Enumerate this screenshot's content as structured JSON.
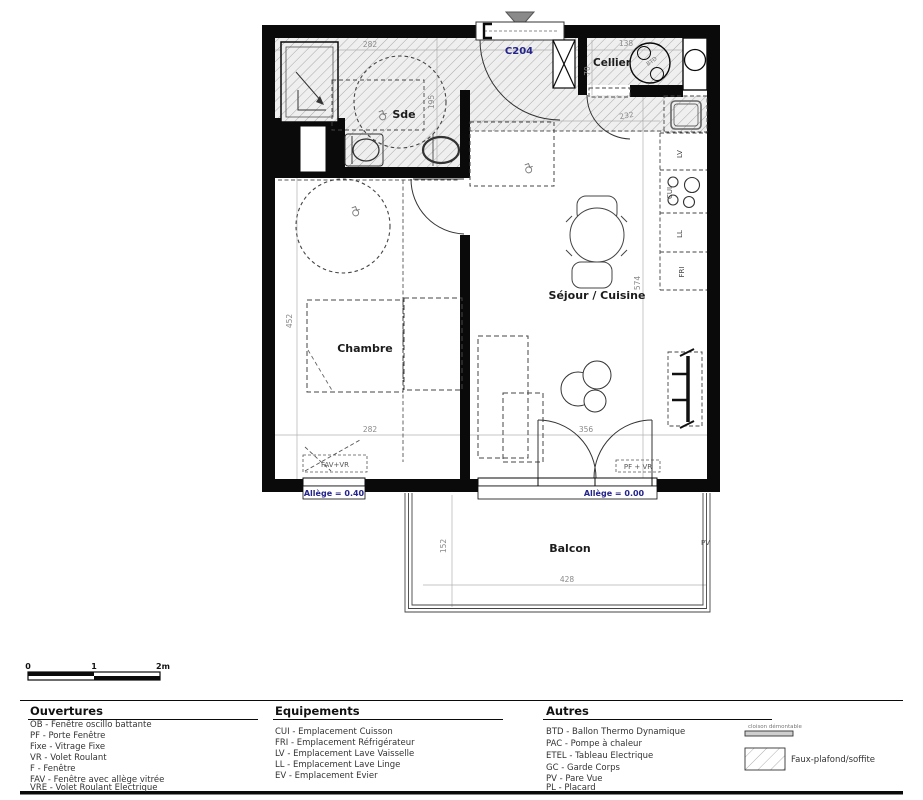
{
  "plan": {
    "unit_label": "C204",
    "rooms": {
      "sde": "Sde",
      "cellier": "Cellier",
      "chambre": "Chambre",
      "sejour": "Séjour / Cuisine",
      "balcon": "Balcon"
    },
    "appliances": {
      "lv": "LV",
      "cui": "CUI",
      "ll": "LL",
      "fri": "FRI",
      "btd": "BTD"
    },
    "windows": {
      "fav_vr": "FAV+VR",
      "pf_vr": "PF + VR",
      "pv": "PV",
      "sill_chambre": "Allège = 0.40",
      "sill_sejour": "Allège = 0.00"
    },
    "dims": {
      "sde_w": "282",
      "sde_h": "195",
      "cellier_w": "138",
      "cellier_h": "70",
      "entry_w": "232",
      "chambre_h": "452",
      "chambre_w": "282",
      "door_w": "356",
      "kitchen_h": "574",
      "balcon_h": "152",
      "balcon_w": "428"
    }
  },
  "scalebar": {
    "t0": "0",
    "t1": "1",
    "t2": "2m"
  },
  "legend": {
    "ouvertures": {
      "title": "Ouvertures",
      "items": [
        "OB - Fenêtre oscillo battante",
        "PF - Porte Fenêtre",
        "Fixe - Vitrage Fixe",
        "VR - Volet Roulant",
        "F - Fenêtre",
        "FAV - Fenêtre avec allège vitrée",
        "VRE - Volet Roulant Electrique"
      ]
    },
    "equipements": {
      "title": "Equipements",
      "items": [
        "CUI - Emplacement Cuisson",
        "FRI - Emplacement Réfrigérateur",
        "LV - Emplacement Lave Vaisselle",
        "LL - Emplacement Lave Linge",
        "EV - Emplacement Evier"
      ]
    },
    "autres": {
      "title": "Autres",
      "items": [
        "BTD - Ballon Thermo Dynamique",
        "PAC - Pompe à chaleur",
        "ETEL - Tableau Electrique",
        "GC - Garde Corps",
        "PV - Pare Vue",
        "PL - Placard"
      ]
    },
    "symbols": {
      "cloison": "cloison démontable",
      "faux_plafond": "Faux-plafond/soffite"
    }
  },
  "colors": {
    "wall": "#0a0a0a",
    "accent_navy": "#23238c",
    "dim_gray": "#8a8a8a",
    "hatch_line": "#a9a9a9"
  }
}
